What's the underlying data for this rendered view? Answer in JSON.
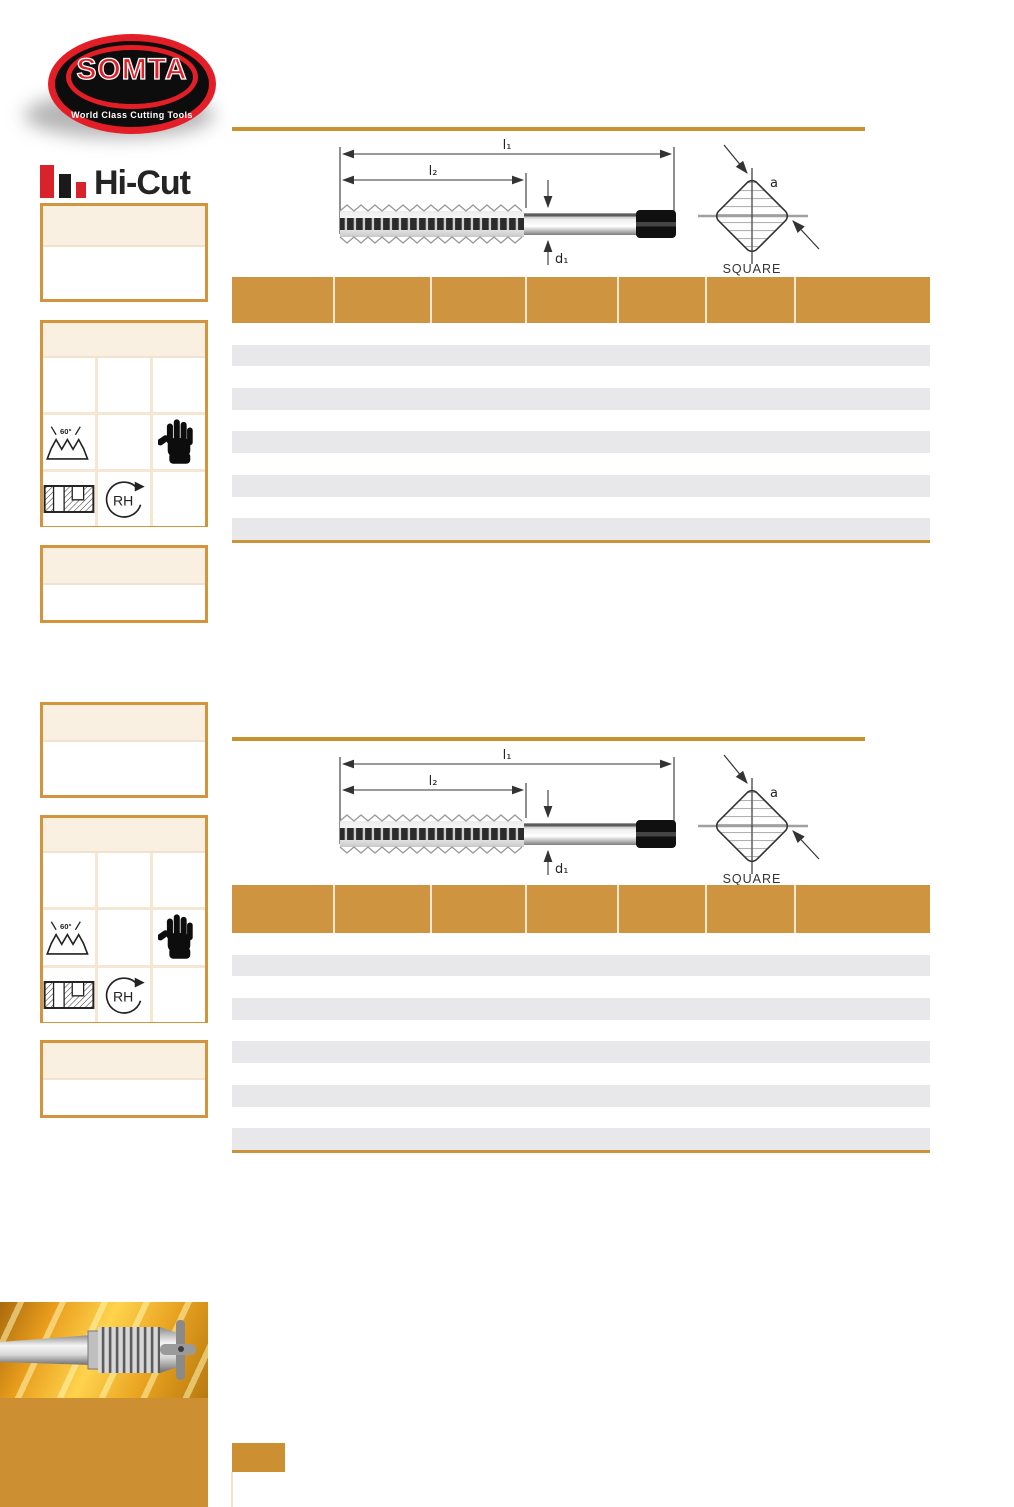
{
  "brand": {
    "logo_title": "SOMTA",
    "logo_tagline": "World Class Cutting Tools",
    "product_line": "Hi-Cut"
  },
  "palette": {
    "accent_orange": "#CE9440",
    "panel_cream": "#FAF0E2",
    "row_gray": "#E8E8EA",
    "brand_red": "#D8232A",
    "ink_black": "#1A1A1A"
  },
  "symbols": {
    "thread_angle_label": "60°",
    "rotation_label": "RH"
  },
  "sections": [
    {
      "diagram": {
        "dim_overall_length": "l₁",
        "dim_thread_length": "l₂",
        "dim_shank_diameter": "d₁",
        "square_dim": "a",
        "square_label": "SQUARE"
      },
      "table": {
        "column_count": 7,
        "row_count": 10,
        "header_labels": [
          "",
          "",
          "",
          "",
          "",
          "",
          ""
        ]
      }
    },
    {
      "diagram": {
        "dim_overall_length": "l₁",
        "dim_thread_length": "l₂",
        "dim_shank_diameter": "d₁",
        "square_dim": "a",
        "square_label": "SQUARE"
      },
      "table": {
        "column_count": 7,
        "row_count": 10,
        "header_labels": [
          "",
          "",
          "",
          "",
          "",
          "",
          ""
        ]
      }
    }
  ]
}
